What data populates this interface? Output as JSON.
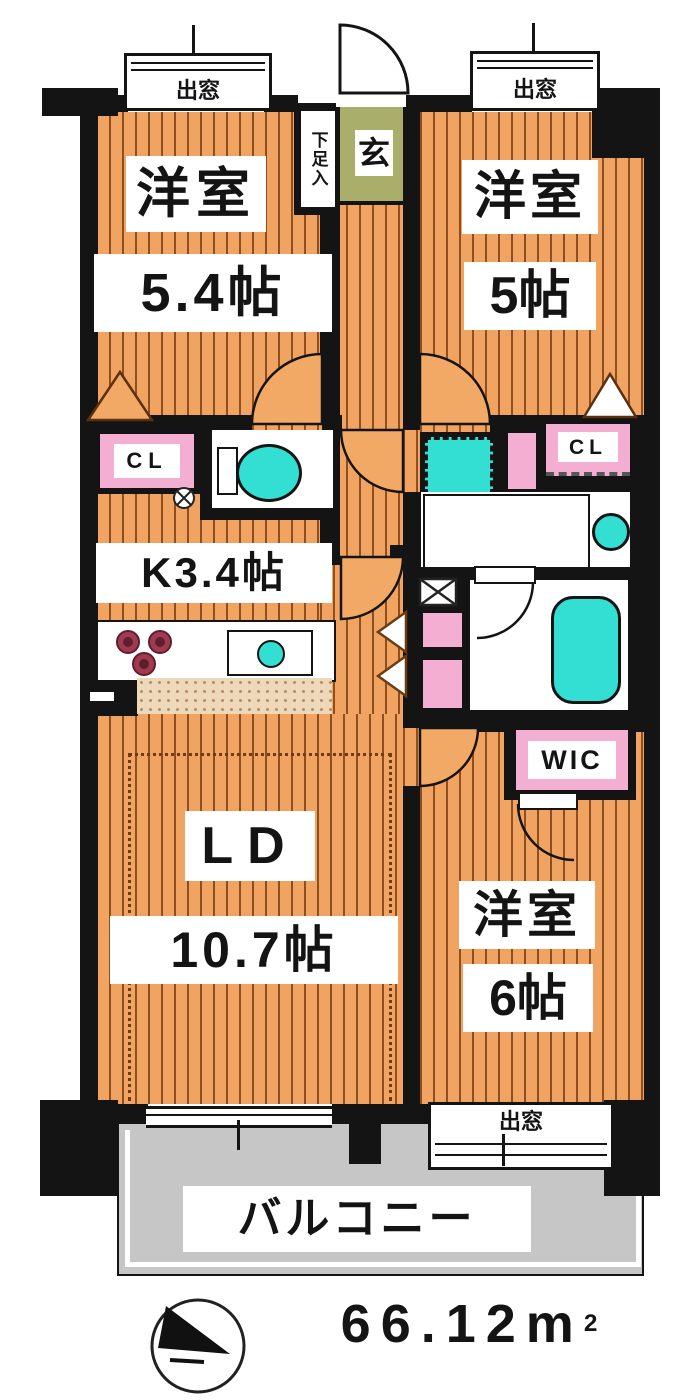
{
  "labels": {
    "bay_window": "出窓",
    "shoe_storage": "下足入",
    "entrance": "玄",
    "closet": "CL",
    "walk_in_closet": "WIC",
    "kitchen": "K3.4帖",
    "balcony": "バルコニー"
  },
  "rooms": {
    "bedroom_nw": {
      "type": "洋室",
      "size": "5.4帖"
    },
    "bedroom_ne": {
      "type": "洋室",
      "size": "5帖"
    },
    "bedroom_se": {
      "type": "洋室",
      "size": "6帖"
    },
    "living_dining": {
      "type": "LD",
      "size": "10.7帖"
    }
  },
  "area": {
    "value": "66.12",
    "unit": "m",
    "sup": "2"
  },
  "colors": {
    "wood_floor": "#F1A462",
    "wall": "#141414",
    "balcony": "#C6C6C6",
    "entrance_floor": "#A9AF6A",
    "closet_pink": "#F3AED1",
    "fixture_teal": "#33DFD3",
    "kitchen_tile": "#EDD8BA"
  }
}
